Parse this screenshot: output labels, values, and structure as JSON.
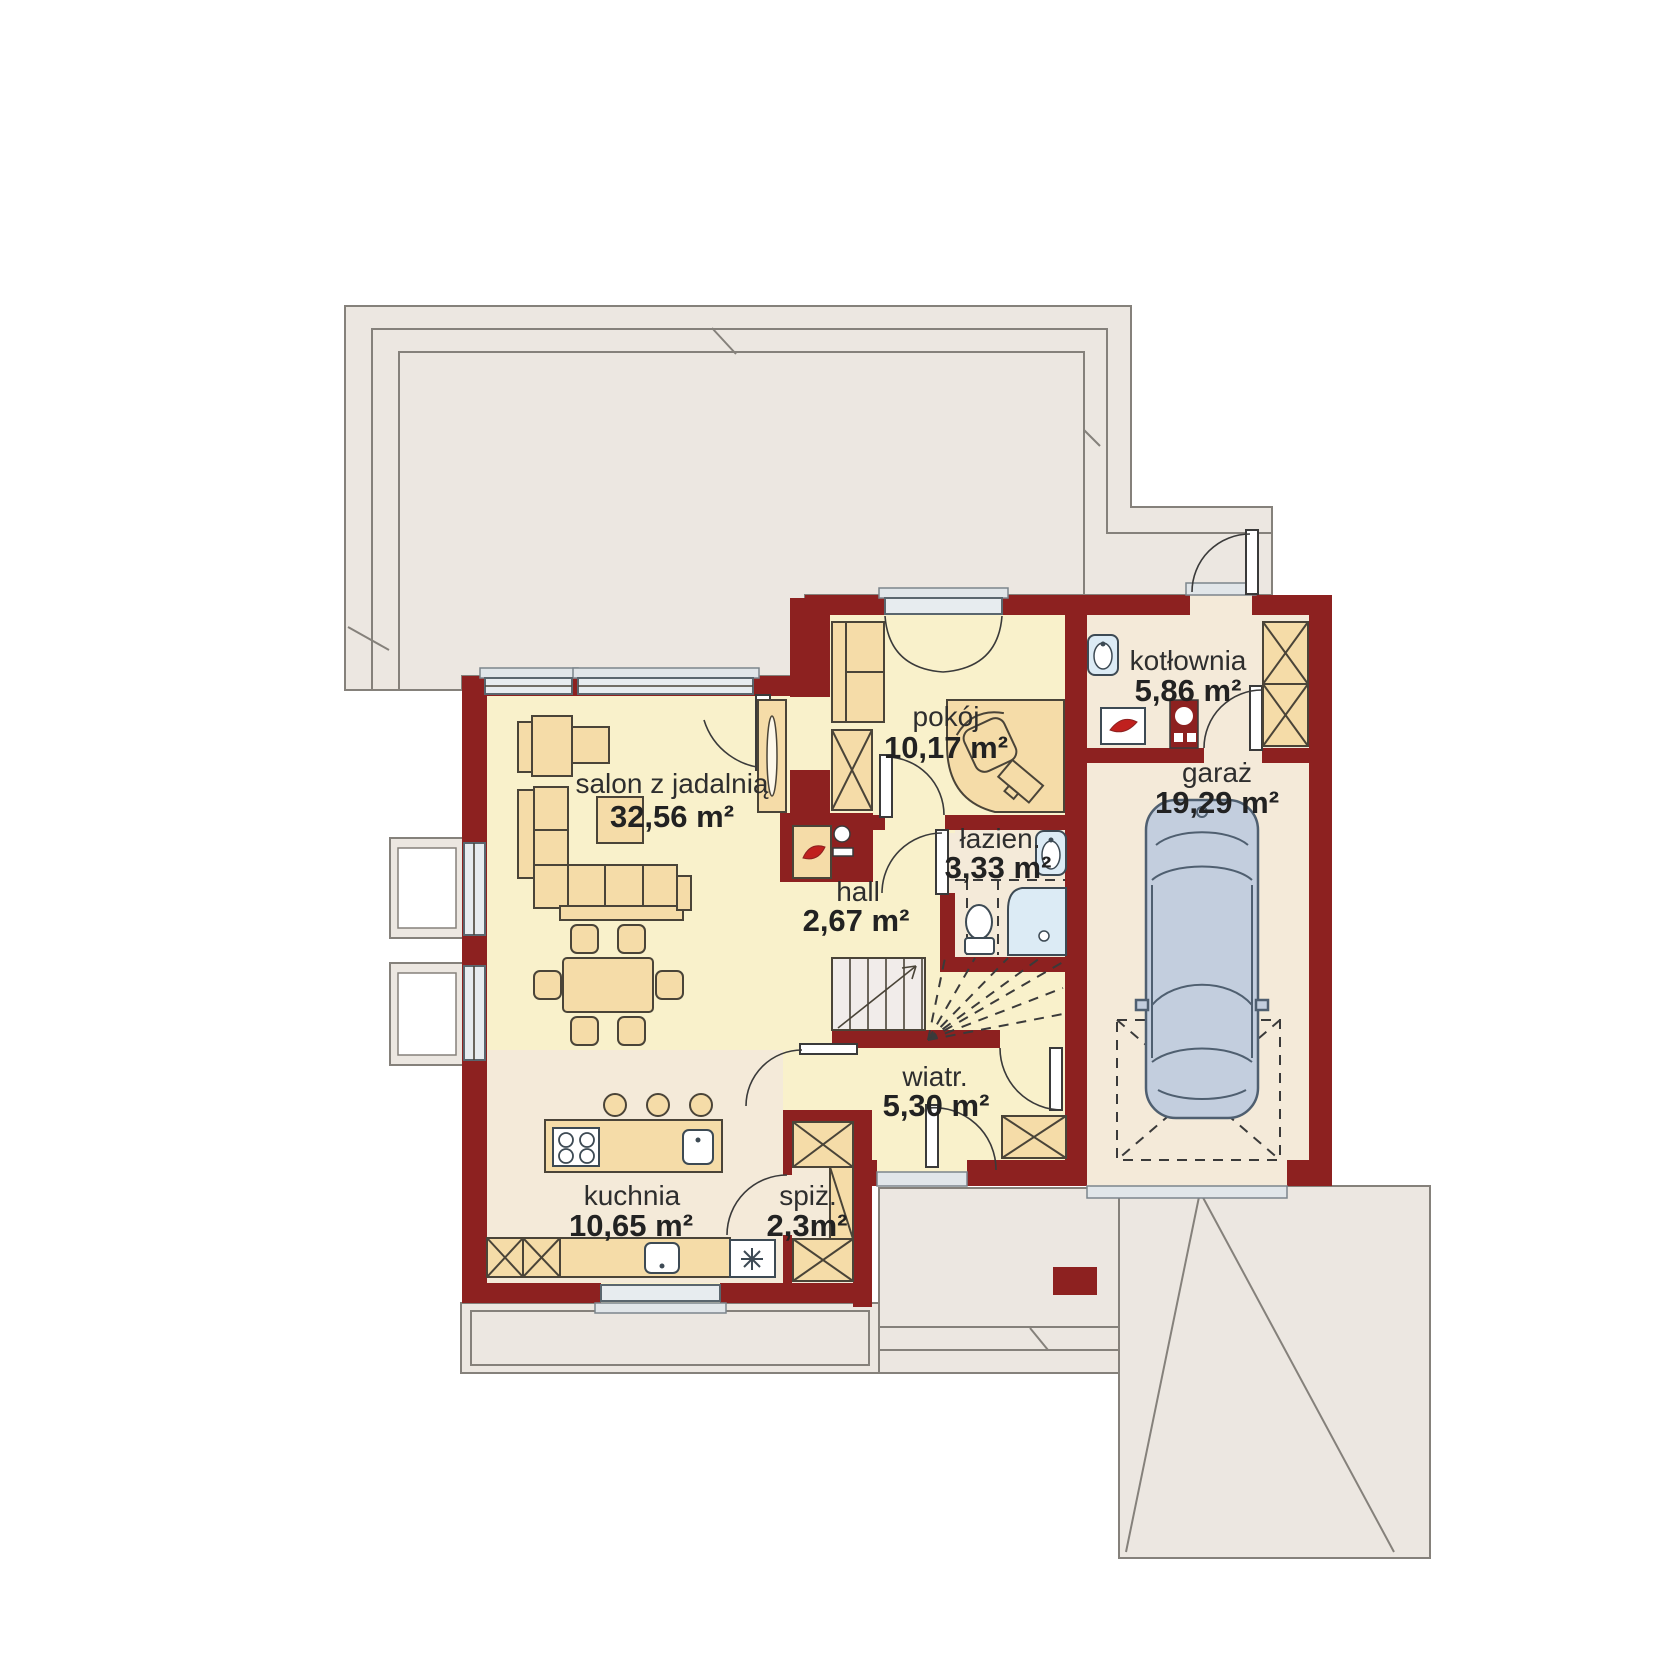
{
  "plan_title": "",
  "palette": {
    "wall": "#8d2120",
    "floor": "#f9f1cb",
    "floor_alt": "#f4ead9",
    "outside": "#ece7e1",
    "outside_line": "#85817b",
    "furniture": "#f5dca8",
    "furniture_line": "#4a4438",
    "fixture": "#dcebf5",
    "car": "#c3cede",
    "accent": "#c0201e"
  },
  "rooms": [
    {
      "id": "salon",
      "name": "salon z jadalnią",
      "area": "32,56 m²"
    },
    {
      "id": "pokoj",
      "name": "pokój",
      "area": "10,17 m²"
    },
    {
      "id": "kotlownia",
      "name": "kotłownia",
      "area": "5,86 m²"
    },
    {
      "id": "garaz",
      "name": "garaż",
      "area": "19,29 m²"
    },
    {
      "id": "lazienka",
      "name": "łazien.",
      "area": "3,33 m²"
    },
    {
      "id": "hall",
      "name": "hall",
      "area": "2,67 m²"
    },
    {
      "id": "wiatrolap",
      "name": "wiatr.",
      "area": "5,30 m²"
    },
    {
      "id": "kuchnia",
      "name": "kuchnia",
      "area": "10,65 m²"
    },
    {
      "id": "spizarnia",
      "name": "spiż.",
      "area": "2,3m²"
    }
  ]
}
